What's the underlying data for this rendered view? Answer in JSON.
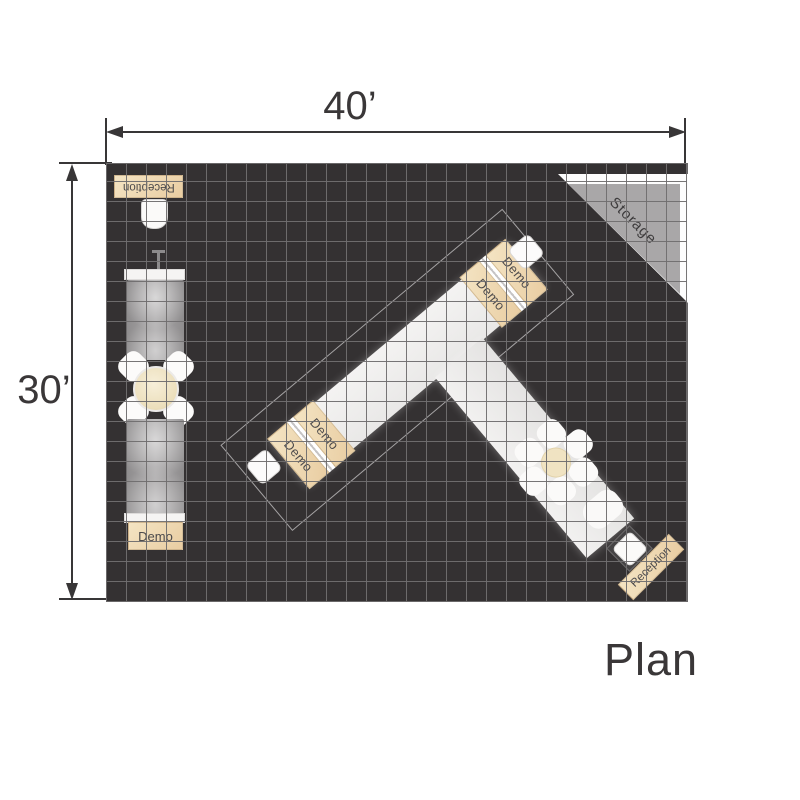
{
  "plan": {
    "title": "Plan",
    "width_label": "40’",
    "height_label": "30’"
  },
  "labels": {
    "reception": "Reception",
    "demo": "Demo",
    "storage": "Storage"
  },
  "colors": {
    "floor": "#343132",
    "grid_line": "#6e6c6d",
    "structure_white": "#f2f1f0",
    "counter_tan": "#eed6ab",
    "panel_gray": "#9b999a",
    "storage_gray": "#a9a7a8",
    "dimension": "#383637"
  }
}
